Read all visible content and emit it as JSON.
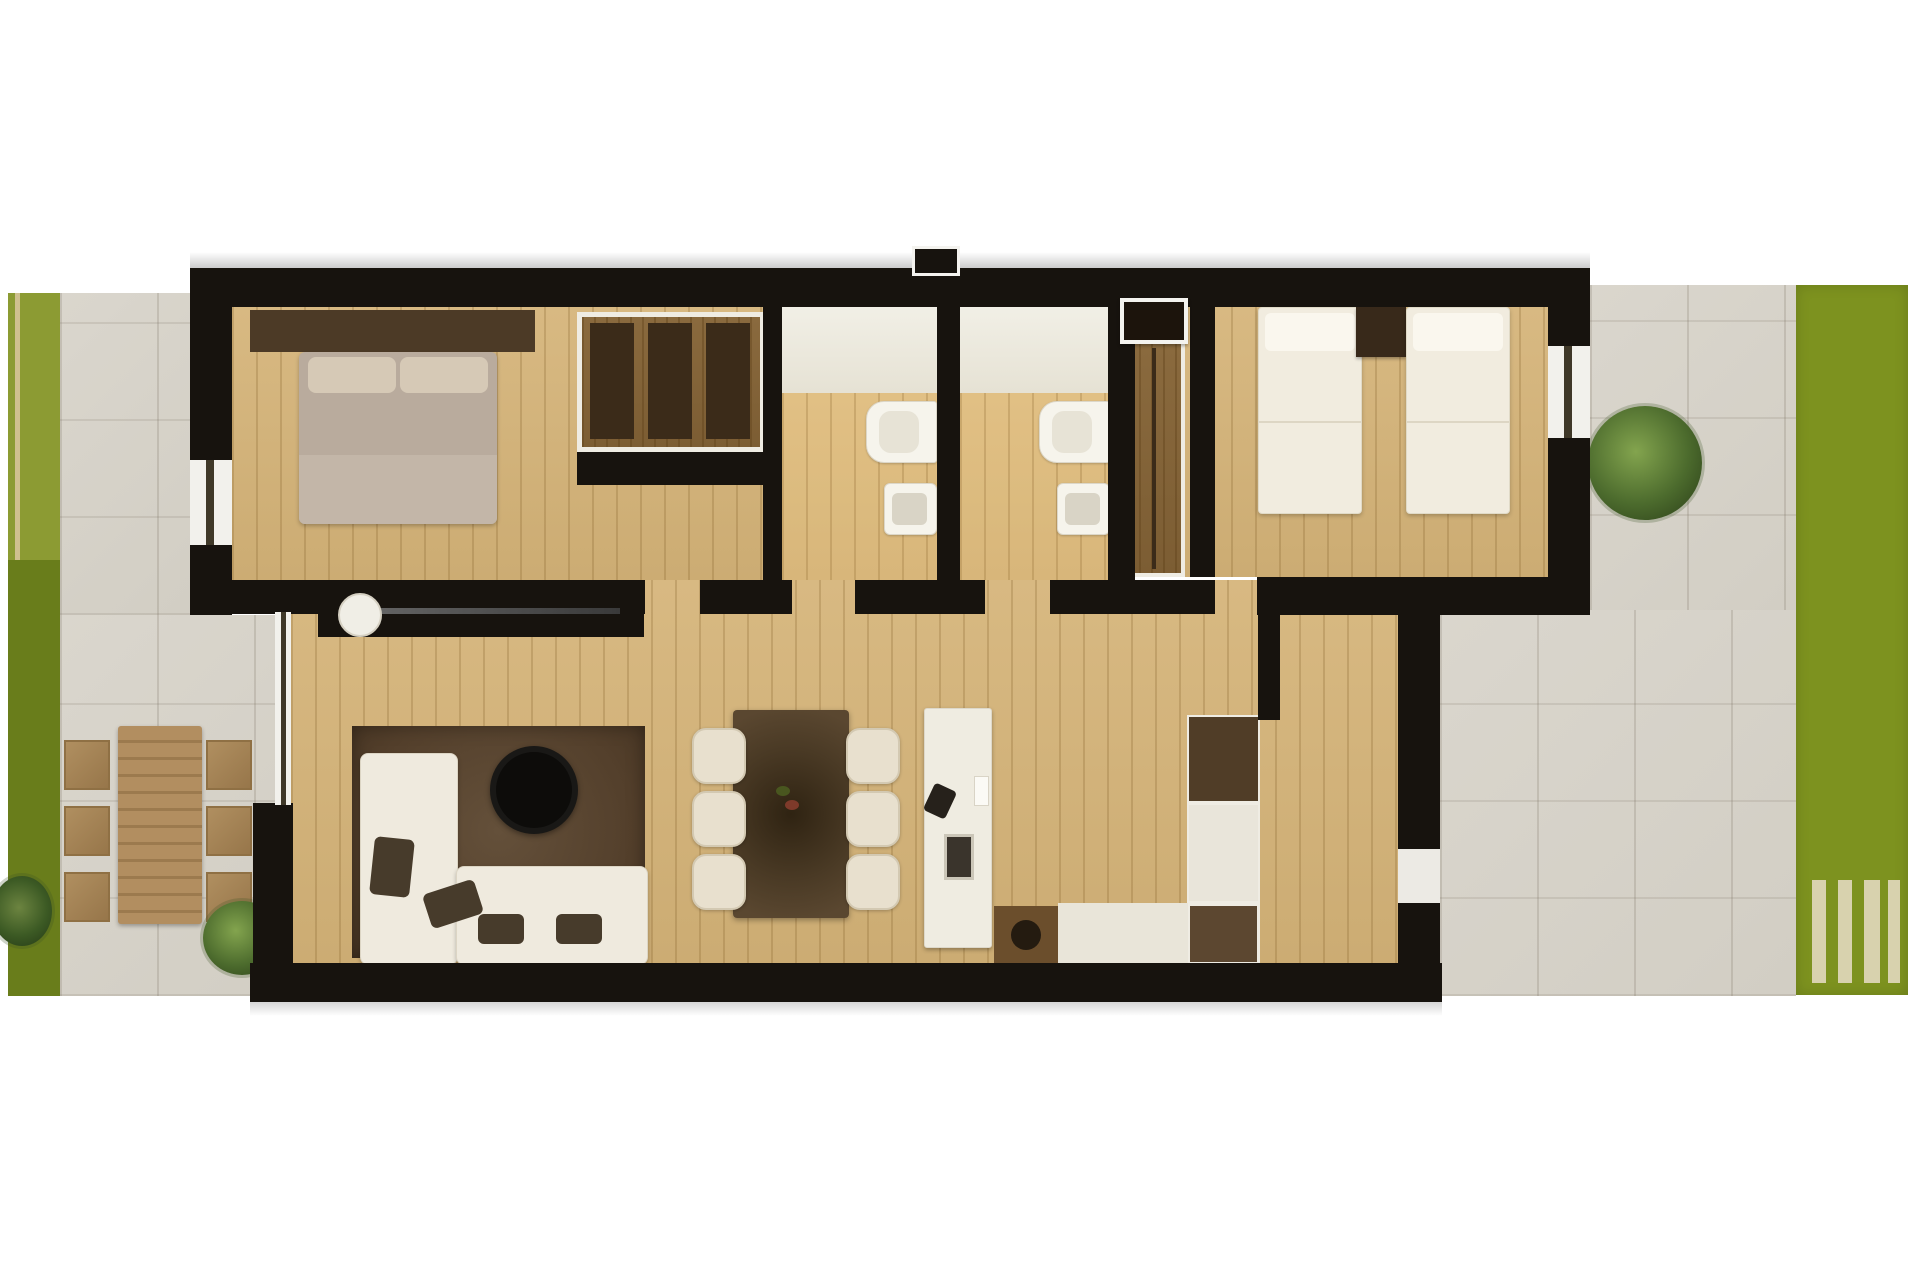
{
  "title": "Top-down 3D architectural floor plan of a two-bedroom apartment with side gardens and tiled terraces",
  "palette": {
    "page_bg": "#ffffff",
    "wall": "#17130e",
    "tile": "#d7d3ca",
    "wood": "#d2b47d",
    "grass_left_top": "#8c9b33",
    "grass_left_bottom": "#697d1b",
    "grass_right": "#7d921f",
    "grass_path_line": "#cfc08f",
    "rug": "#59452f",
    "sofa": "#efeade",
    "cushion": "#473b2b",
    "coffee_table": "#0d0c0a",
    "dining_table": "#4a3a25",
    "dining_chair": "#e8e0ce",
    "bed_duvet": "#b9ab9d",
    "bed_white": "#f1ecdf",
    "headboard": "#4c3a26",
    "wardrobe_wood": "#8a6a3e",
    "wardrobe_panel": "#3b2b19",
    "kitchen_island": "#efece1",
    "fridge_wood": "#503d27",
    "counter": "#e9e5d9",
    "cabinet_brown": "#6b4e2c",
    "outdoor_table": "#b28e60",
    "outdoor_chair": "#ab8a5b",
    "shrub_green": "#4c6b2d",
    "vanity": "#edeadf",
    "fixture_white": "#f6f4ec",
    "deck_slat": "#d8d2ae"
  },
  "outdoor": {
    "left_garden": {
      "items": [
        "grass-strip-light",
        "grass-strip-dark",
        "gravel-path-line",
        "round-bush",
        "corner-bush"
      ]
    },
    "left_terrace": {
      "items": [
        "tiled-patio",
        "outdoor-dining-table",
        "outdoor-chair",
        "outdoor-chair",
        "outdoor-chair",
        "outdoor-chair",
        "outdoor-chair",
        "outdoor-chair"
      ]
    },
    "right_terrace": {
      "items": [
        "tiled-patio",
        "shrub-planter",
        "entrance-threshold"
      ]
    },
    "right_garden": {
      "items": [
        "lawn",
        "deck-slat",
        "deck-slat",
        "deck-slat",
        "deck-slat"
      ]
    }
  },
  "rooms": [
    {
      "id": "bedroom-1",
      "items": [
        "double-bed",
        "pillow",
        "pillow",
        "headboard-panel",
        "built-in-wardrobe",
        "window"
      ]
    },
    {
      "id": "bathroom-1",
      "items": [
        "vanity-counter",
        "toilet",
        "bidet",
        "door-opening"
      ]
    },
    {
      "id": "bathroom-2",
      "items": [
        "vanity-counter",
        "toilet",
        "bidet",
        "door-opening",
        "high-window-box"
      ]
    },
    {
      "id": "bedroom-2",
      "items": [
        "single-bed",
        "single-bed",
        "nightstand",
        "sliding-wardrobe",
        "window",
        "door-opening"
      ]
    },
    {
      "id": "living-room",
      "items": [
        "sectional-sofa-chaise",
        "sectional-sofa-seat",
        "cushion",
        "cushion",
        "cushion",
        "cushion",
        "round-coffee-table",
        "area-rug",
        "wall-mounted-tv",
        "round-side-decor",
        "sliding-glass-door"
      ]
    },
    {
      "id": "dining-area",
      "items": [
        "dining-table",
        "dining-chair",
        "dining-chair",
        "dining-chair",
        "dining-chair",
        "dining-chair",
        "dining-chair",
        "centerpiece"
      ]
    },
    {
      "id": "kitchen",
      "items": [
        "island-counter",
        "sink",
        "faucet",
        "jar",
        "tall-fridge-oven-unit",
        "base-counter",
        "cooktop-cabinet",
        "cooktop-ring"
      ]
    },
    {
      "id": "entry-hall",
      "items": [
        "entrance-door-opening"
      ]
    }
  ]
}
